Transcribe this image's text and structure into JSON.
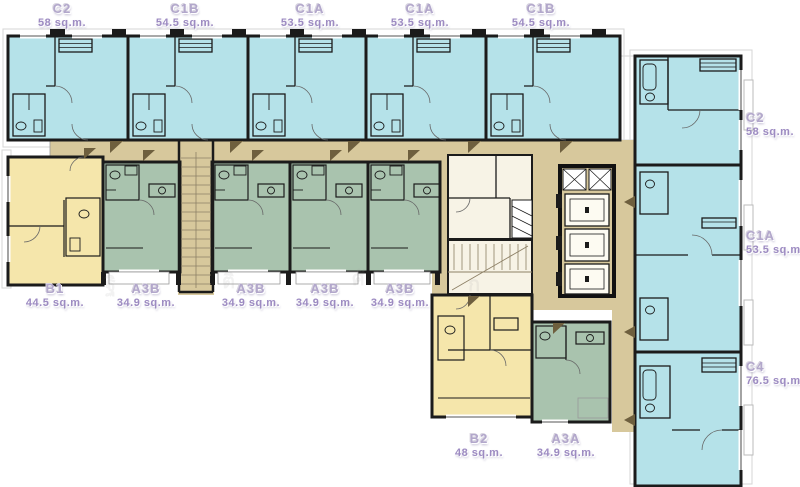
{
  "plan": {
    "description": "Residential condominium typical floor plan",
    "colors": {
      "c_units": "#b5e2e9",
      "a_units": "#a9c3ae",
      "b_units": "#f5e6ab",
      "corridor": "#d7c89c",
      "wall": "#1b1b1b",
      "label_name": "#b2a7cb",
      "label_area": "#9d8bc2"
    },
    "top_row": [
      {
        "name": "C2",
        "area": "58 sq.m."
      },
      {
        "name": "C1B",
        "area": "54.5 sq.m."
      },
      {
        "name": "C1A",
        "area": "53.5 sq.m."
      },
      {
        "name": "C1A",
        "area": "53.5 sq.m."
      },
      {
        "name": "C1B",
        "area": "54.5 sq.m."
      }
    ],
    "right_column": [
      {
        "name": "C2",
        "area": "58 sq.m."
      },
      {
        "name": "C1A",
        "area": "53.5 sq.m."
      },
      {
        "name": "C4",
        "area": "76.5 sq.m."
      }
    ],
    "middle_row": [
      {
        "name": "B1",
        "area": "44.5 sq.m."
      },
      {
        "name": "A3B",
        "area": "34.9 sq.m."
      },
      {
        "name": "A3B",
        "area": "34.9 sq.m."
      },
      {
        "name": "A3B",
        "area": "34.9 sq.m."
      },
      {
        "name": "A3B",
        "area": "34.9 sq.m."
      }
    ],
    "bottom_row": [
      {
        "name": "B2",
        "area": "48 sq.m."
      },
      {
        "name": "A3A",
        "area": "34.9 sq.m."
      }
    ],
    "core": {
      "elevators": 3,
      "stairwells": 2
    },
    "watermark": [
      "ฐิ",
      "ติ",
      "ศั",
      "ก"
    ]
  }
}
